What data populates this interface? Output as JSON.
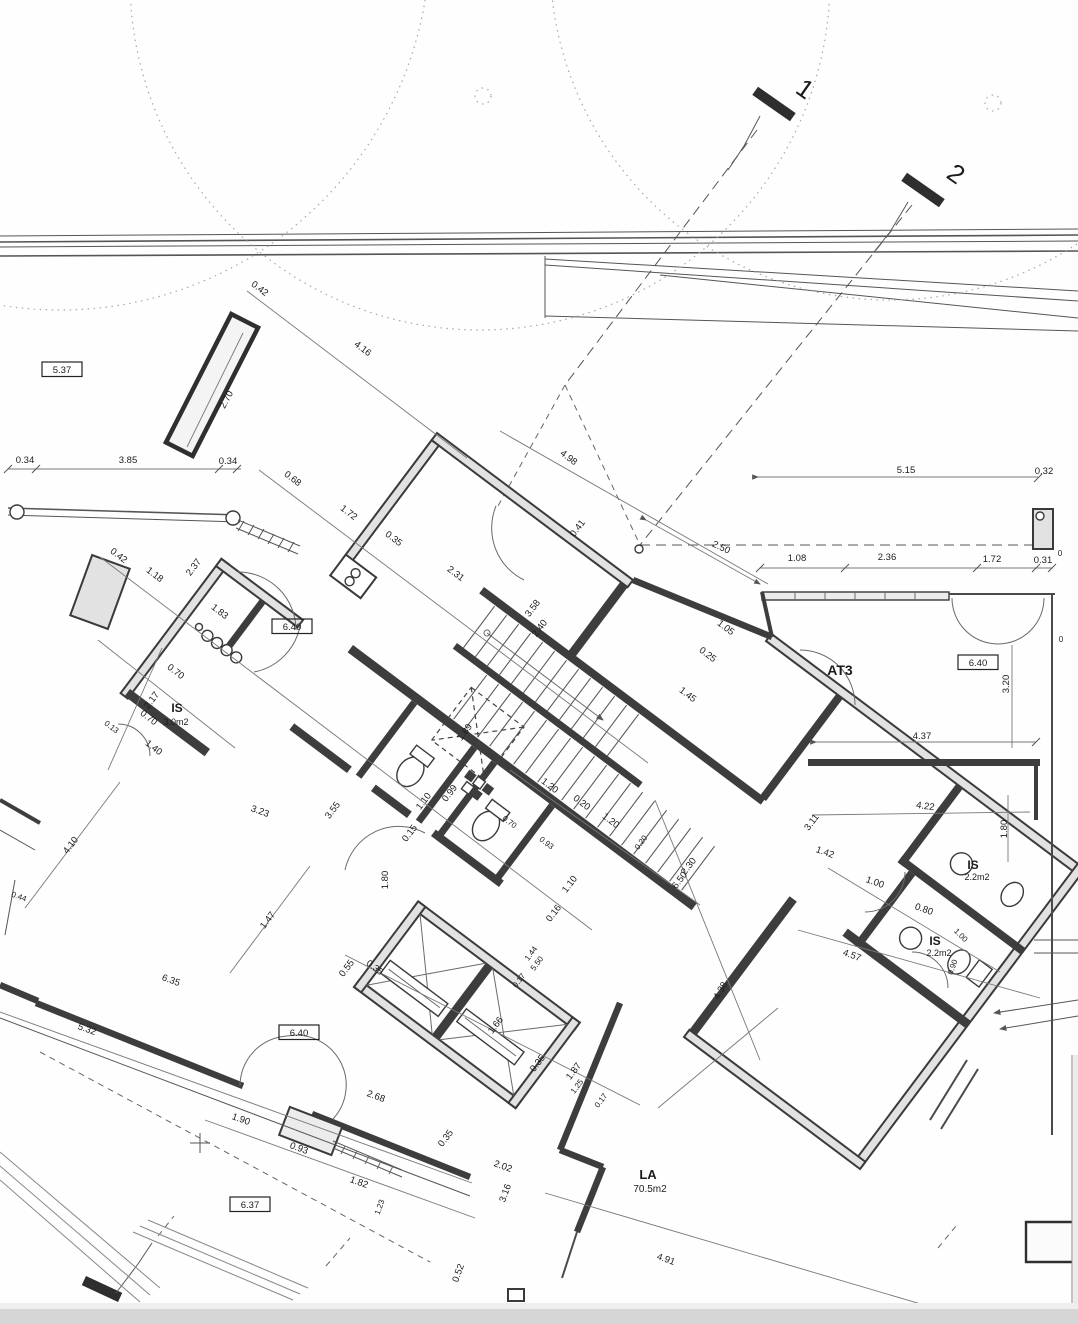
{
  "plan": {
    "section_markers": [
      "1",
      "2"
    ],
    "level_markers": [
      "5.37",
      "6.40",
      "6.40",
      "6.40",
      "6.37"
    ],
    "rooms": [
      {
        "name": "IS",
        "area": "3.0m2"
      },
      {
        "name": "AT3",
        "area": ""
      },
      {
        "name": "IS",
        "area": "2.2m2"
      },
      {
        "name": "IS",
        "area": "2.2m2"
      },
      {
        "name": "LA",
        "area": "70.5m2"
      }
    ]
  },
  "labels": [
    {
      "t": "0.42",
      "x": 258,
      "y": 291,
      "r": 37
    },
    {
      "t": "4.16",
      "x": 361,
      "y": 351,
      "r": 37
    },
    {
      "t": "2.70",
      "x": 229,
      "y": 401,
      "r": -62
    },
    {
      "t": "5.37",
      "x": 62,
      "y": 373,
      "box": 1
    },
    {
      "t": "0.34",
      "x": 25,
      "y": 463
    },
    {
      "t": "3.85",
      "x": 128,
      "y": 463
    },
    {
      "t": "0.34",
      "x": 228,
      "y": 464
    },
    {
      "t": "0.68",
      "x": 291,
      "y": 481,
      "r": 37
    },
    {
      "t": "1.72",
      "x": 347,
      "y": 515,
      "r": 37
    },
    {
      "t": "0.35",
      "x": 392,
      "y": 541,
      "r": 37
    },
    {
      "t": "2.31",
      "x": 454,
      "y": 576,
      "r": 37
    },
    {
      "t": "4.98",
      "x": 567,
      "y": 460,
      "r": 37
    },
    {
      "t": "0.41",
      "x": 580,
      "y": 530,
      "r": -53
    },
    {
      "t": "2.50",
      "x": 720,
      "y": 550,
      "r": 25
    },
    {
      "t": "5.15",
      "x": 906,
      "y": 473
    },
    {
      "t": "0.32",
      "x": 1044,
      "y": 474
    },
    {
      "t": "1.08",
      "x": 797,
      "y": 561
    },
    {
      "t": "2.36",
      "x": 887,
      "y": 560
    },
    {
      "t": "1.72",
      "x": 992,
      "y": 562
    },
    {
      "t": "0.31",
      "x": 1043,
      "y": 563
    },
    {
      "t": "0",
      "x": 1060,
      "y": 556,
      "s": 8
    },
    {
      "t": "0",
      "x": 1061,
      "y": 642,
      "s": 8
    },
    {
      "t": "0.42",
      "x": 117,
      "y": 558,
      "r": 37
    },
    {
      "t": "1.18",
      "x": 153,
      "y": 577,
      "r": 37
    },
    {
      "t": "2.37",
      "x": 196,
      "y": 569,
      "r": -53
    },
    {
      "t": "1.83",
      "x": 218,
      "y": 614,
      "r": 37
    },
    {
      "t": "6.40",
      "x": 292,
      "y": 630,
      "box": 1
    },
    {
      "t": "0.70",
      "x": 174,
      "y": 674,
      "r": 37
    },
    {
      "t": "2.17",
      "x": 154,
      "y": 702,
      "r": -53
    },
    {
      "t": "0.70",
      "x": 147,
      "y": 720,
      "r": 37
    },
    {
      "t": "IS",
      "x": 177,
      "y": 712,
      "s": 12,
      "b": 1,
      "n": "room-label-is-left"
    },
    {
      "t": "3.0m2",
      "x": 176,
      "y": 725,
      "s": 9,
      "n": "room-area-is-left"
    },
    {
      "t": "1.40",
      "x": 152,
      "y": 750,
      "r": 37
    },
    {
      "t": "0.13",
      "x": 110,
      "y": 729,
      "r": 37,
      "s": 8
    },
    {
      "t": "3.58",
      "x": 535,
      "y": 610,
      "r": -53
    },
    {
      "t": "2.40",
      "x": 542,
      "y": 630,
      "r": -53
    },
    {
      "t": "1.05",
      "x": 724,
      "y": 630,
      "r": 37
    },
    {
      "t": "0.25",
      "x": 706,
      "y": 657,
      "r": 37
    },
    {
      "t": "1.45",
      "x": 686,
      "y": 697,
      "r": 37
    },
    {
      "t": "1.89",
      "x": 467,
      "y": 734,
      "r": -53
    },
    {
      "t": "1.20",
      "x": 548,
      "y": 788,
      "r": 37
    },
    {
      "t": "0.20",
      "x": 580,
      "y": 805,
      "r": 37
    },
    {
      "t": "1.20",
      "x": 609,
      "y": 823,
      "r": 37
    },
    {
      "t": "1.10",
      "x": 426,
      "y": 803,
      "r": -53
    },
    {
      "t": "0.99",
      "x": 452,
      "y": 795,
      "r": -53
    },
    {
      "t": "0.15",
      "x": 412,
      "y": 835,
      "r": -53
    },
    {
      "t": "1.80",
      "x": 388,
      "y": 880,
      "r": -90
    },
    {
      "t": "0.70",
      "x": 508,
      "y": 824,
      "r": 37,
      "s": 8
    },
    {
      "t": "0.93",
      "x": 545,
      "y": 845,
      "r": 37,
      "s": 8
    },
    {
      "t": "1.10",
      "x": 572,
      "y": 886,
      "r": -53
    },
    {
      "t": "0.16",
      "x": 556,
      "y": 915,
      "r": -53
    },
    {
      "t": "1.44",
      "x": 533,
      "y": 955,
      "r": -53,
      "s": 8
    },
    {
      "t": "5.50",
      "x": 539,
      "y": 965,
      "r": -53,
      "s": 8
    },
    {
      "t": "0.17",
      "x": 521,
      "y": 982,
      "r": -53,
      "s": 8
    },
    {
      "t": "0.55",
      "x": 349,
      "y": 970,
      "r": -53
    },
    {
      "t": "3.55",
      "x": 335,
      "y": 812,
      "r": -53
    },
    {
      "t": "3.23",
      "x": 259,
      "y": 814,
      "r": 20
    },
    {
      "t": "4.10",
      "x": 73,
      "y": 847,
      "r": -53
    },
    {
      "t": "0.44",
      "x": 18,
      "y": 899,
      "r": 20,
      "s": 8
    },
    {
      "t": "1.47",
      "x": 270,
      "y": 922,
      "r": -53
    },
    {
      "t": "6.35",
      "x": 170,
      "y": 983,
      "r": 20
    },
    {
      "t": "5.32",
      "x": 86,
      "y": 1032,
      "r": 20
    },
    {
      "t": "6.40",
      "x": 299,
      "y": 1036,
      "box": 1
    },
    {
      "t": "0.35",
      "x": 373,
      "y": 970,
      "r": 37
    },
    {
      "t": "1.66",
      "x": 498,
      "y": 1027,
      "r": -53
    },
    {
      "t": "0.35",
      "x": 540,
      "y": 1065,
      "r": -53
    },
    {
      "t": "1.87",
      "x": 576,
      "y": 1073,
      "r": -53
    },
    {
      "t": "1.25",
      "x": 579,
      "y": 1088,
      "r": -53,
      "s": 8
    },
    {
      "t": "0.17",
      "x": 603,
      "y": 1102,
      "r": -53,
      "s": 8
    },
    {
      "t": "2.68",
      "x": 375,
      "y": 1099,
      "r": 20
    },
    {
      "t": "1.90",
      "x": 240,
      "y": 1122,
      "r": 20
    },
    {
      "t": "0.93",
      "x": 298,
      "y": 1151,
      "r": 20
    },
    {
      "t": "1.82",
      "x": 358,
      "y": 1185,
      "r": 20
    },
    {
      "t": "6.37",
      "x": 250,
      "y": 1208,
      "box": 1
    },
    {
      "t": "1.23",
      "x": 382,
      "y": 1208,
      "r": -70,
      "s": 8
    },
    {
      "t": "0.35",
      "x": 448,
      "y": 1140,
      "r": -53
    },
    {
      "t": "2.02",
      "x": 502,
      "y": 1169,
      "r": 20
    },
    {
      "t": "3.16",
      "x": 508,
      "y": 1194,
      "r": -70
    },
    {
      "t": "LA",
      "x": 648,
      "y": 1179,
      "s": 13,
      "b": 1,
      "n": "room-label-la"
    },
    {
      "t": "70.5m2",
      "x": 650,
      "y": 1192,
      "s": 10,
      "n": "room-area-la"
    },
    {
      "t": "4.91",
      "x": 665,
      "y": 1262,
      "r": 20
    },
    {
      "t": "0.52",
      "x": 461,
      "y": 1274,
      "r": -70
    },
    {
      "t": "AT3",
      "x": 840,
      "y": 675,
      "s": 14,
      "b": 1,
      "n": "room-label-at3"
    },
    {
      "t": "6.40",
      "x": 978,
      "y": 666,
      "box": 1
    },
    {
      "t": "3.20",
      "x": 1009,
      "y": 684,
      "r": -90
    },
    {
      "t": "4.37",
      "x": 922,
      "y": 739
    },
    {
      "t": "4.22",
      "x": 925,
      "y": 809,
      "r": 8
    },
    {
      "t": "3.11",
      "x": 814,
      "y": 824,
      "r": -53
    },
    {
      "t": "1.80",
      "x": 1007,
      "y": 829,
      "r": -90
    },
    {
      "t": "1.42",
      "x": 824,
      "y": 855,
      "r": 20
    },
    {
      "t": "IS",
      "x": 973,
      "y": 869,
      "s": 12,
      "b": 1,
      "n": "room-label-is-right-top"
    },
    {
      "t": "2.2m2",
      "x": 977,
      "y": 880,
      "s": 9,
      "n": "room-area-is-right-top"
    },
    {
      "t": "1.00",
      "x": 874,
      "y": 885,
      "r": 20
    },
    {
      "t": "0.80",
      "x": 923,
      "y": 912,
      "r": 20
    },
    {
      "t": "1.00",
      "x": 959,
      "y": 937,
      "r": 45,
      "s": 8
    },
    {
      "t": "IS",
      "x": 935,
      "y": 945,
      "s": 12,
      "b": 1,
      "n": "room-label-is-right-bottom"
    },
    {
      "t": "2.2m2",
      "x": 939,
      "y": 956,
      "s": 9,
      "n": "room-area-is-right-bottom"
    },
    {
      "t": "4.57",
      "x": 851,
      "y": 958,
      "r": 20
    },
    {
      "t": "6.50",
      "x": 682,
      "y": 882,
      "r": -53
    },
    {
      "t": "2.30",
      "x": 691,
      "y": 868,
      "r": -53
    },
    {
      "t": "4.38",
      "x": 723,
      "y": 992,
      "r": -60
    },
    {
      "t": "0.20",
      "x": 643,
      "y": 844,
      "r": -53,
      "s": 8
    },
    {
      "t": "0.90",
      "x": 955,
      "y": 968,
      "r": -70,
      "s": 8
    }
  ]
}
